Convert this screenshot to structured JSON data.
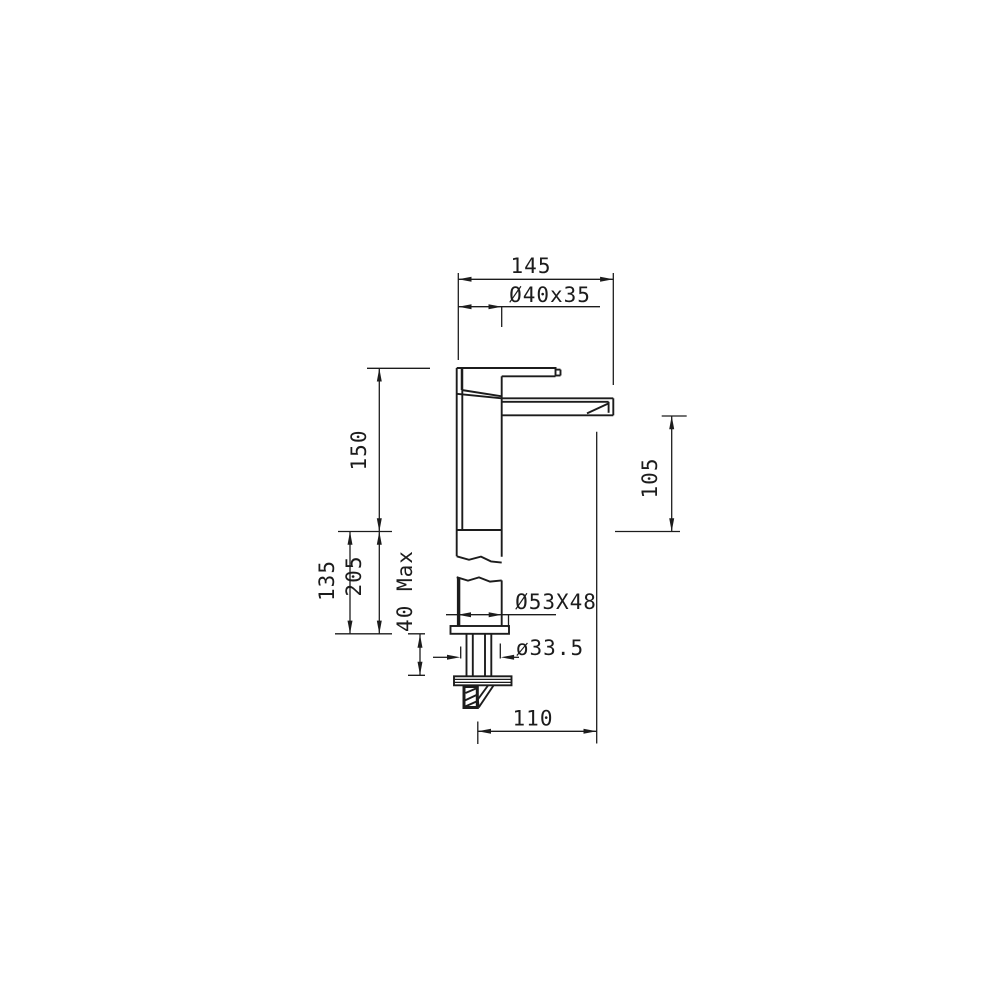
{
  "colors": {
    "background": "#ffffff",
    "line": "#1c1c1c"
  },
  "dimensions": {
    "overall_width": {
      "label": "145"
    },
    "top_body_section": {
      "label": "Ø40x35"
    },
    "spout_height": {
      "label": "150"
    },
    "spout_to_plane": {
      "label": "105"
    },
    "plane_to_deck": {
      "label": "135"
    },
    "overall_height": {
      "label": "205"
    },
    "deck_thickness_max": {
      "label": "40 Max"
    },
    "base_section": {
      "label": "Ø53X48"
    },
    "shank_diameter": {
      "label": "ø33.5"
    },
    "spout_reach": {
      "label": "110"
    }
  }
}
